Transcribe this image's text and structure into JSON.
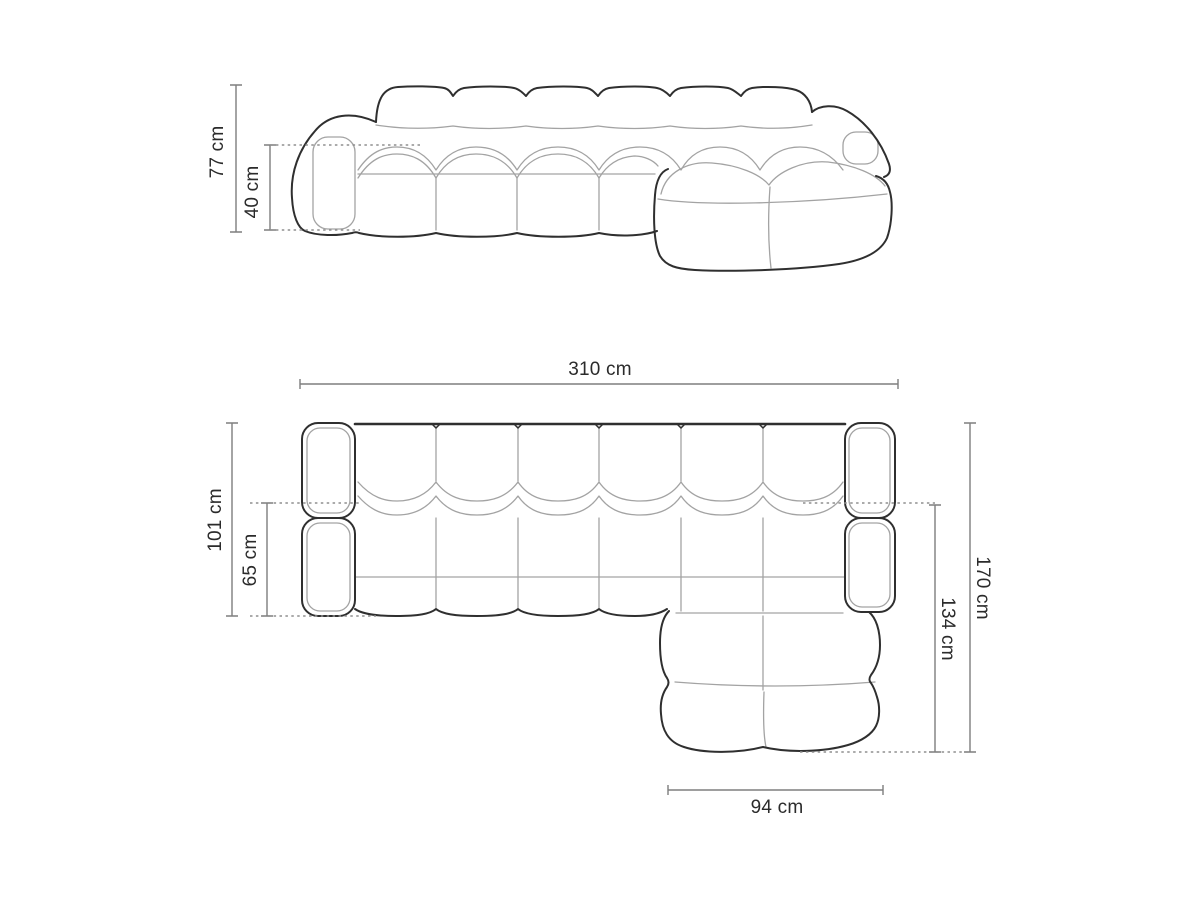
{
  "diagram": {
    "type": "sofa-dimension-drawing",
    "views": {
      "front": "front-elevation",
      "top": "top-plan"
    }
  },
  "dimensions": {
    "front_total_height": "77 cm",
    "front_seat_height": "40 cm",
    "top_total_width": "310 cm",
    "top_body_depth": "101 cm",
    "top_seat_depth": "65 cm",
    "top_total_depth_with_chaise": "170 cm",
    "top_chaise_depth": "134 cm",
    "top_chaise_width": "94 cm"
  },
  "colors": {
    "background": "#ffffff",
    "outline": "#2f2f2f",
    "seam": "#a3a3a3",
    "dimension_line": "#7e7e7e",
    "dashed_line": "#8f8f8f",
    "label_text": "#2b2b2b"
  }
}
